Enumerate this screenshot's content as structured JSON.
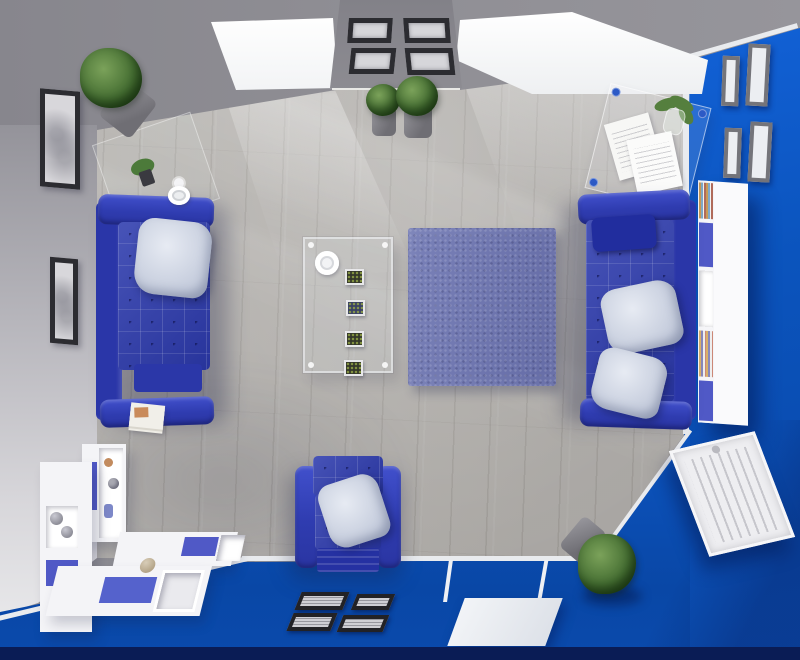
{
  "meta": {
    "title": "Top-down 3D render of a blue and white living room",
    "view": "bird's-eye interior render, no visible text"
  },
  "palette": {
    "wall-gray": "#8f8e94",
    "wall-light": "#c9c8cd",
    "wall-blue": "#0b54bd",
    "wall-blue-deep": "#0947a6",
    "floor-wood": "#b5b2ae",
    "sofa-blue": "#2e3cae",
    "sofa-blue-light": "#4150cc",
    "rug-blue": "#6e76b2",
    "pillow-light": "#c6cddd",
    "frame-dark": "#2c2c31",
    "frame-gray": "#74747a",
    "shelf-white": "#f4f4f7",
    "panel-blue": "#5059c6",
    "plant-green": "#46702f",
    "pot-gray": "#8b8a90",
    "radiator-white": "#eeeef1",
    "door-white": "#f2f4f7",
    "baseboard-white": "#e9ebee",
    "bottom-edge": "#0a1c55"
  },
  "scene": {
    "objects": [
      {
        "name": "wood-floor",
        "label": "Light gray wood plank floor with sunlight shafts"
      },
      {
        "name": "top-wall",
        "label": "Gray top wall with two bright skylights"
      },
      {
        "name": "left-wall",
        "label": "Light gray left wall"
      },
      {
        "name": "right-wall",
        "label": "Bright blue right wall"
      },
      {
        "name": "bottom-wall",
        "label": "Bright blue bottom wall"
      },
      {
        "name": "skylight-left",
        "label": "Left skylight window"
      },
      {
        "name": "skylight-right",
        "label": "Right skylight window"
      },
      {
        "name": "gallery-column",
        "label": "Gray wall column with four dark picture frames"
      },
      {
        "name": "corner-plant",
        "label": "Green potted plant in top-left corner"
      },
      {
        "name": "console-table",
        "label": "Glass console table with small plant and cup"
      },
      {
        "name": "desk",
        "label": "Glass desk with papers and plant in vase"
      },
      {
        "name": "right-wall-frames",
        "label": "Four gray picture frames on blue wall"
      },
      {
        "name": "bookcase",
        "label": "White wall bookcase with blue doors and books"
      },
      {
        "name": "left-sofa",
        "label": "Blue tufted sofa with light gray pillow"
      },
      {
        "name": "right-sofa",
        "label": "Blue tufted sofa with headrest and two light pillows"
      },
      {
        "name": "armchair",
        "label": "Blue tufted armchair with light gray pillow"
      },
      {
        "name": "rug",
        "label": "Blue shag rug"
      },
      {
        "name": "coffee-table",
        "label": "Glass coffee table with cup and four plant trays"
      },
      {
        "name": "floor-plants",
        "label": "Two potted plants below gallery column"
      },
      {
        "name": "left-wall-frames",
        "label": "Two black picture frames on left wall"
      },
      {
        "name": "radiator",
        "label": "White panel radiator on blue wall"
      },
      {
        "name": "corner-shelf",
        "label": "White L-shaped corner shelving with blue panels and decor"
      },
      {
        "name": "bottom-frames",
        "label": "Four dark picture frames on bottom blue wall"
      },
      {
        "name": "door",
        "label": "White door on bottom wall"
      },
      {
        "name": "bottom-plant",
        "label": "Green potted plant near bottom-right corner"
      },
      {
        "name": "books",
        "label": "Stack of magazines on the floor"
      },
      {
        "name": "cup",
        "label": "Cup and saucer on the floor"
      }
    ]
  }
}
